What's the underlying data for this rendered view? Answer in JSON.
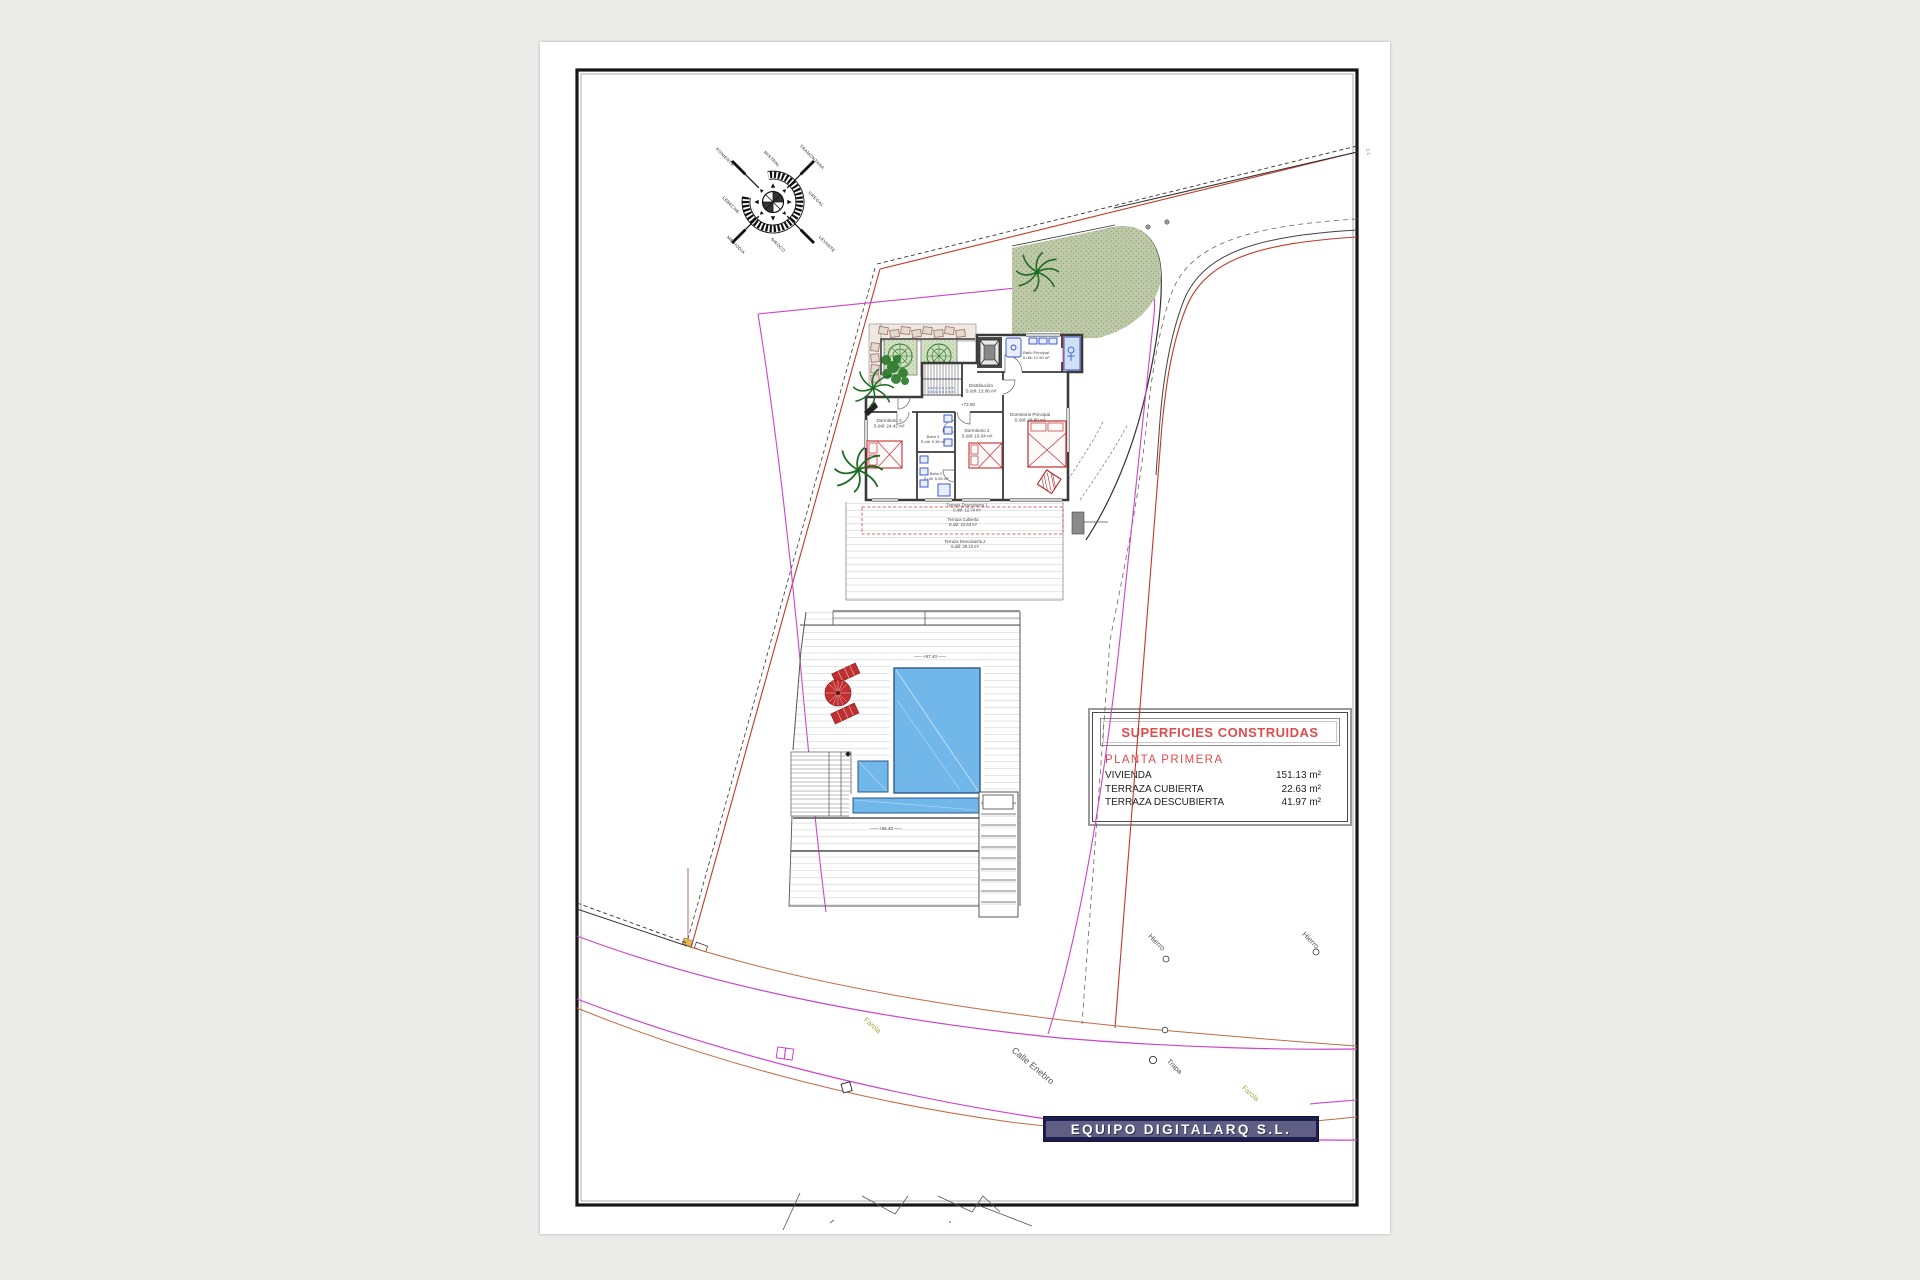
{
  "sheet": {
    "background": "#ffffff",
    "frame_color": "#161616"
  },
  "compass": {
    "winds": {
      "nw": "PONIENTE",
      "n": "MISTRAL",
      "ne": "TRAMONTANA",
      "e": "GREGAL",
      "se": "LEVANTE",
      "s": "SIROCO",
      "sw": "MEDIODIA",
      "w": "LEBECHE"
    }
  },
  "floor_plan": {
    "rooms": {
      "distribucion": {
        "name": "Distribución",
        "area": "S.útil: 13.08 m²"
      },
      "bano_principal": {
        "name": "Baño Principal",
        "area": "S.útil: 12.90 m²"
      },
      "dormitorio_principal": {
        "name": "Dormitorio Principal",
        "area": "S.útil: 26.80 m²"
      },
      "dormitorio_2": {
        "name": "Dormitorio 2",
        "area": "S.útil: 19.04 m²"
      },
      "dormitorio_3": {
        "name": "Dormitorio 3",
        "area": "S.útil: 24.42 m²"
      },
      "bano_2": {
        "name": "Baño 2",
        "area": "S.útil: 5.06 m²"
      },
      "bano_3": {
        "name": "Baño 3",
        "area": "S.útil: 5.38 m²"
      }
    },
    "levels": {
      "floor": "+72.80",
      "deck": "+67.40",
      "pool": "+66.40"
    },
    "terraces": {
      "descubierta_1": {
        "name": "Terraza Descubierta 1",
        "area": "S.útil: 12.74 m²"
      },
      "cubierta": {
        "name": "Terraza Cubierta",
        "area": "S.útil: 22.63 m²"
      },
      "descubierta_2": {
        "name": "Terraza Descubierta 2",
        "area": "S.útil: 29.23 m²"
      }
    }
  },
  "site": {
    "street_name": "Calle Enebro",
    "iron_marker": "Hierro",
    "drain_marker": "Trapa",
    "streetlight_marker": "Farola",
    "edge_annotation": "2.1."
  },
  "summary_table": {
    "title": "SUPERFICIES CONSTRUIDAS",
    "section": "PLANTA PRIMERA",
    "rows": [
      {
        "label": "VIVIENDA",
        "value": "151.13 m²"
      },
      {
        "label": "TERRAZA CUBIERTA",
        "value": "22.63 m²"
      },
      {
        "label": "TERRAZA DESCUBIERTA",
        "value": "41.97 m²"
      }
    ]
  },
  "footer": {
    "company": "EQUIPO DIGITALARQ S.L."
  },
  "colors": {
    "boundary_red": "#c0392b",
    "boundary_magenta": "#cc44cc",
    "road_orange": "#c46a45",
    "pool_blue": "#72b7ea",
    "green_area": "#bec9a8",
    "table_accent": "#e04b4b",
    "banner_bg": "#1e1e4e",
    "banner_band": "#5f5f86"
  }
}
